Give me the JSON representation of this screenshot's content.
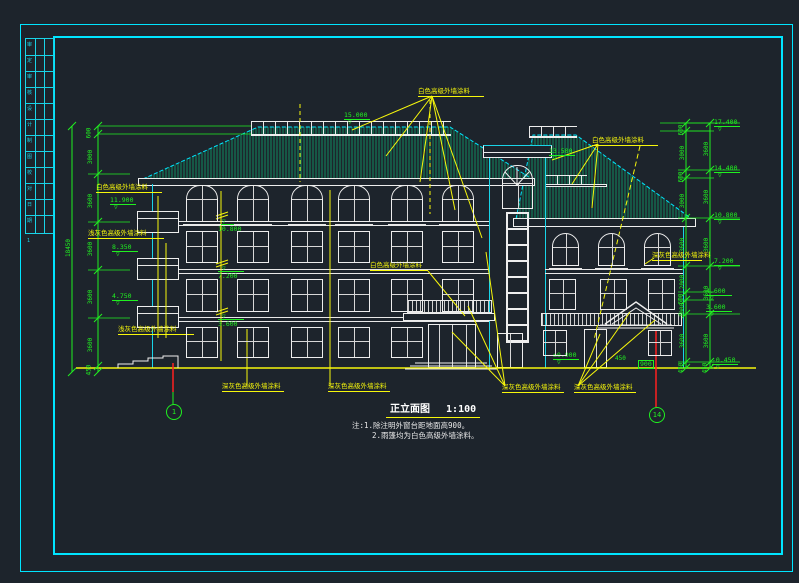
{
  "drawing": {
    "title": "正立面图",
    "scale": "1:100",
    "notes": [
      "注:1.除注明外窗台距地面高900。",
      "2.雨篷均为白色高级外墙涂料。"
    ]
  },
  "axes": [
    {
      "label": "1"
    },
    {
      "label": "14"
    }
  ],
  "paint_labels": [
    {
      "t": "白色高级外墙涂料",
      "x": 96,
      "y": 184,
      "w": 66
    },
    {
      "t": "浅灰色高级外墙涂料",
      "x": 88,
      "y": 230,
      "w": 76
    },
    {
      "t": "浅灰色高级外墙涂料",
      "x": 118,
      "y": 326,
      "w": 76
    },
    {
      "t": "深灰色高级外墙涂料",
      "x": 222,
      "y": 383,
      "w": 62
    },
    {
      "t": "深灰色高级外墙涂料",
      "x": 328,
      "y": 383,
      "w": 62
    },
    {
      "t": "深灰色高级外墙涂料",
      "x": 502,
      "y": 384,
      "w": 62
    },
    {
      "t": "深灰色高级外墙涂料",
      "x": 574,
      "y": 384,
      "w": 62
    },
    {
      "t": "白色高级外墙涂料",
      "x": 418,
      "y": 88,
      "w": 66
    },
    {
      "t": "白色高级外墙涂料",
      "x": 592,
      "y": 137,
      "w": 66
    },
    {
      "t": "白色高级外墙涂料",
      "x": 370,
      "y": 262,
      "w": 58
    },
    {
      "t": "深灰色高级外墙涂料",
      "x": 652,
      "y": 252,
      "w": 50
    }
  ],
  "elevations": [
    {
      "v": "15.000",
      "x": 344,
      "y": 111
    },
    {
      "v": "13.500",
      "x": 549,
      "y": 147
    },
    {
      "v": "17.400",
      "x": 714,
      "y": 118
    },
    {
      "v": "14.400",
      "x": 714,
      "y": 164
    },
    {
      "v": "10.800",
      "x": 714,
      "y": 211
    },
    {
      "v": "7.200",
      "x": 714,
      "y": 257
    },
    {
      "v": "4.600",
      "x": 706,
      "y": 287
    },
    {
      "v": "3.600",
      "x": 706,
      "y": 303
    },
    {
      "v": "-0.450",
      "x": 712,
      "y": 356
    },
    {
      "v": "11.900",
      "x": 110,
      "y": 196
    },
    {
      "v": "8.350",
      "x": 112,
      "y": 243
    },
    {
      "v": "4.750",
      "x": 112,
      "y": 292
    },
    {
      "v": "10.800",
      "x": 218,
      "y": 224,
      "dir": "below"
    },
    {
      "v": "7.200",
      "x": 218,
      "y": 271,
      "dir": "below"
    },
    {
      "v": "3.600",
      "x": 218,
      "y": 319,
      "dir": "below"
    },
    {
      "v": "±0.000",
      "x": 553,
      "y": 351
    },
    {
      "v": "450",
      "x": 615,
      "y": 356,
      "plain": true
    },
    {
      "v": "900",
      "x": 638,
      "y": 360,
      "plain": true,
      "boxed": true
    }
  ],
  "dims": {
    "overall_left": {
      "t": "18450",
      "x": 60,
      "y": 245
    },
    "left_items": [
      {
        "t": "600",
        "x": 84,
        "y": 130
      },
      {
        "t": "3000",
        "x": 84,
        "y": 154
      },
      {
        "t": "3600",
        "x": 84,
        "y": 198
      },
      {
        "t": "3600",
        "x": 84,
        "y": 246
      },
      {
        "t": "3600",
        "x": 84,
        "y": 294
      },
      {
        "t": "3600",
        "x": 84,
        "y": 342
      },
      {
        "t": "450",
        "x": 84,
        "y": 367
      }
    ],
    "right_inner_items": [
      {
        "t": "600",
        "x": 676,
        "y": 127
      },
      {
        "t": "3000",
        "x": 676,
        "y": 150
      },
      {
        "t": "600",
        "x": 676,
        "y": 174
      },
      {
        "t": "3000",
        "x": 676,
        "y": 198
      },
      {
        "t": "3600",
        "x": 676,
        "y": 242
      },
      {
        "t": "2000",
        "x": 676,
        "y": 279
      },
      {
        "t": "600",
        "x": 676,
        "y": 296
      },
      {
        "t": "1000",
        "x": 676,
        "y": 307
      },
      {
        "t": "3600",
        "x": 676,
        "y": 338
      },
      {
        "t": "450",
        "x": 676,
        "y": 365
      }
    ],
    "right_outer_items": [
      {
        "t": "3600",
        "x": 700,
        "y": 146
      },
      {
        "t": "3600",
        "x": 700,
        "y": 194
      },
      {
        "t": "3600",
        "x": 700,
        "y": 242
      },
      {
        "t": "3600",
        "x": 700,
        "y": 290
      },
      {
        "t": "3600",
        "x": 700,
        "y": 338
      },
      {
        "t": "450",
        "x": 700,
        "y": 365
      }
    ]
  },
  "titleblock": {
    "cells": [
      "审",
      "定",
      "审",
      "核",
      "设",
      "计",
      "制",
      "图",
      "校",
      "对",
      "日",
      "期"
    ],
    "footer": "1"
  },
  "colors": {
    "bg": "#1d242c",
    "cyan": "#00e5ff",
    "green": "#20f020",
    "yellow": "#f7f70c",
    "white": "#f2f2f2",
    "red": "#ff2020",
    "roof_hatch": "#0e8a5f"
  }
}
